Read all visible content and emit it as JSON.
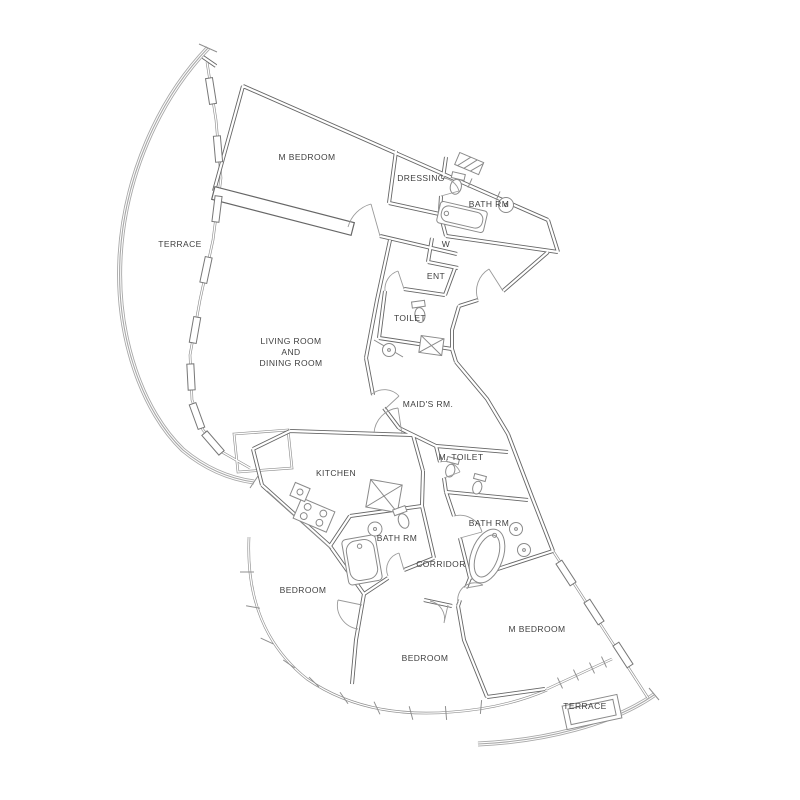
{
  "drawing": {
    "type": "apartment-floor-plan",
    "colors": {
      "background": "#ffffff",
      "wall_line": "#666666",
      "thin_line": "#8f8f8f",
      "rail_line": "#a8a8a8",
      "label_text": "#3f3f3f"
    }
  },
  "rooms": {
    "m_bedroom_top": {
      "label": "M BEDROOM"
    },
    "dressing": {
      "label": "DRESSING"
    },
    "bath_top": {
      "label": "BATH RM"
    },
    "terrace_left": {
      "label": "TERRACE"
    },
    "closet_w": {
      "label": "W"
    },
    "entrance": {
      "label": "ENT"
    },
    "toilet": {
      "label": "TOILET"
    },
    "living": {
      "lines": [
        "LIVING ROOM",
        "AND",
        "DINING ROOM"
      ]
    },
    "maids_room": {
      "label": "MAID'S RM."
    },
    "kitchen": {
      "label": "KITCHEN"
    },
    "m_toilet": {
      "label": "M. TOILET"
    },
    "bath_mid": {
      "label": "BATH RM"
    },
    "bath_right": {
      "label": "BATH RM"
    },
    "corridor": {
      "label": "CORRIDOR"
    },
    "bedroom_left": {
      "label": "BEDROOM"
    },
    "bedroom_bottom": {
      "label": "BEDROOM"
    },
    "m_bedroom_bottom": {
      "label": "M BEDROOM"
    },
    "terrace_bottom": {
      "label": "TERRACE"
    }
  }
}
